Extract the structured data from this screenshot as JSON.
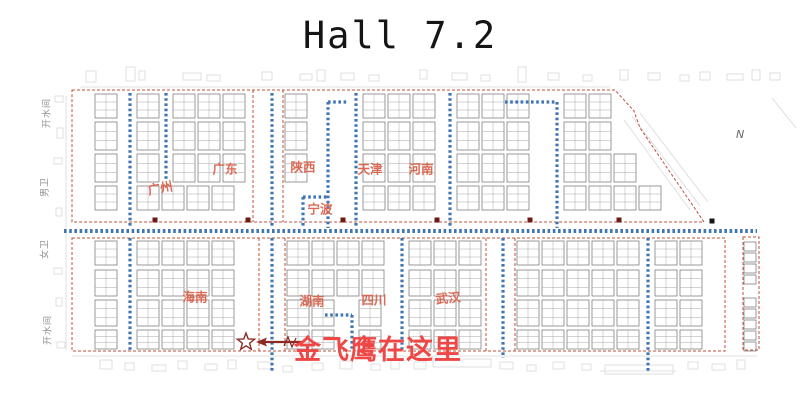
{
  "title": "Hall 7.2",
  "compass": "N",
  "annotation": {
    "text": "金飞鹰在这里",
    "color": "#ee4745",
    "arrow_color": "#8e2a25",
    "marker_icon": "star-icon"
  },
  "region_label_color": "#d85f48",
  "region_labels": [
    {
      "text": "广州"
    },
    {
      "text": "广东"
    },
    {
      "text": "陕西"
    },
    {
      "text": "天津"
    },
    {
      "text": "河南"
    },
    {
      "text": "宁波"
    },
    {
      "text": "海南"
    },
    {
      "text": "湖南"
    },
    {
      "text": "四川"
    },
    {
      "text": "武汉"
    }
  ],
  "facility_labels": [
    {
      "text": "开水间"
    },
    {
      "text": "男卫"
    },
    {
      "text": "女卫"
    },
    {
      "text": "开水间"
    }
  ],
  "floorplan": {
    "colors": {
      "outline": "#c0503a",
      "aisle": "#3f74b5",
      "booth": "#6e6e6e",
      "booth_inner": "#a8a8a8",
      "pillar": "#6b1b13",
      "pillar_black": "#151515",
      "deco": "#d8d8d8",
      "marker": "#8e2a25"
    },
    "booth": {
      "w": 22,
      "gap": 3
    },
    "bands": [
      {
        "y": 94,
        "h": 24,
        "x0": 95,
        "x1": 612,
        "gaps": [
          [
            124,
            136
          ],
          [
            160,
            172
          ],
          [
            252,
            284
          ],
          [
            322,
            334
          ],
          [
            350,
            362
          ],
          [
            444,
            456
          ],
          [
            551,
            563
          ]
        ]
      },
      {
        "y": 122,
        "h": 28,
        "x0": 95,
        "x1": 634,
        "gaps": [
          [
            124,
            136
          ],
          [
            160,
            172
          ],
          [
            252,
            284
          ],
          [
            322,
            334
          ],
          [
            350,
            362
          ],
          [
            444,
            456
          ],
          [
            551,
            563
          ]
        ]
      },
      {
        "y": 154,
        "h": 28,
        "x0": 95,
        "x1": 654,
        "gaps": [
          [
            124,
            136
          ],
          [
            160,
            172
          ],
          [
            252,
            284
          ],
          [
            322,
            334
          ],
          [
            350,
            362
          ],
          [
            444,
            456
          ],
          [
            551,
            563
          ]
        ]
      },
      {
        "y": 186,
        "h": 24,
        "x0": 95,
        "x1": 676,
        "gaps": [
          [
            124,
            136
          ],
          [
            252,
            284
          ],
          [
            297,
            309
          ],
          [
            322,
            334
          ],
          [
            350,
            362
          ],
          [
            444,
            456
          ],
          [
            551,
            563
          ]
        ]
      },
      {
        "y": 241,
        "h": 24,
        "x0": 95,
        "x1": 715,
        "gaps": [
          [
            124,
            136
          ],
          [
            258,
            286
          ],
          [
            396,
            408
          ],
          [
            485,
            516
          ],
          [
            642,
            654
          ]
        ]
      },
      {
        "y": 270,
        "h": 26,
        "x0": 95,
        "x1": 715,
        "gaps": [
          [
            124,
            136
          ],
          [
            258,
            286
          ],
          [
            396,
            408
          ],
          [
            485,
            516
          ],
          [
            642,
            654
          ]
        ]
      },
      {
        "y": 300,
        "h": 26,
        "x0": 95,
        "x1": 715,
        "gaps": [
          [
            124,
            136
          ],
          [
            258,
            286
          ],
          [
            346,
            358
          ],
          [
            396,
            408
          ],
          [
            485,
            516
          ],
          [
            642,
            654
          ]
        ]
      },
      {
        "y": 330,
        "h": 19,
        "x0": 95,
        "x1": 715,
        "gaps": [
          [
            124,
            136
          ],
          [
            258,
            286
          ],
          [
            346,
            358
          ],
          [
            396,
            408
          ],
          [
            485,
            516
          ],
          [
            642,
            654
          ]
        ]
      }
    ],
    "strip": {
      "x": 744,
      "w": 12,
      "h": 9,
      "cells": [
        242,
        253,
        264,
        275,
        298,
        309,
        320,
        331,
        342
      ]
    },
    "outlines": [
      "M72,90 L615,90 L634,111 L640,128 L704,222 L72,222 Z",
      "M72,238 H725 V351 H72 Z",
      "M743,237 H759 V350 H743 Z",
      "M253,90 V222",
      "M283,90 V222",
      "M259,238 V351",
      "M285,238 V351",
      "M486,238 V351",
      "M515,238 V351"
    ],
    "aisles": [
      [
        64,
        231,
        757,
        231,
        4
      ],
      [
        130,
        93,
        130,
        228,
        3.2
      ],
      [
        166,
        93,
        166,
        180,
        3.2
      ],
      [
        272,
        93,
        272,
        228,
        3.2
      ],
      [
        303,
        197,
        303,
        228,
        3.2
      ],
      [
        328,
        102,
        328,
        228,
        3.2
      ],
      [
        356,
        93,
        356,
        228,
        3.2
      ],
      [
        450,
        93,
        450,
        228,
        3.2
      ],
      [
        557,
        102,
        557,
        228,
        3.2
      ],
      [
        303,
        197,
        328,
        197,
        3.2
      ],
      [
        328,
        102,
        348,
        102,
        3.2
      ],
      [
        505,
        102,
        557,
        102,
        3.2
      ],
      [
        130,
        238,
        130,
        351,
        3.2
      ],
      [
        272,
        238,
        272,
        372,
        3.2
      ],
      [
        352,
        315,
        352,
        351,
        3.2
      ],
      [
        402,
        238,
        402,
        351,
        3.2
      ],
      [
        503,
        238,
        503,
        358,
        3.2
      ],
      [
        648,
        238,
        648,
        373,
        3.2
      ],
      [
        325,
        315,
        352,
        315,
        3.2
      ]
    ],
    "pillars": [
      [
        155,
        220
      ],
      [
        248,
        220
      ],
      [
        343,
        220
      ],
      [
        437,
        220
      ],
      [
        530,
        220
      ],
      [
        619,
        220
      ],
      [
        712,
        221,
        "b"
      ]
    ],
    "marker": {
      "cx": 246,
      "cy": 342,
      "r": 9
    },
    "deco": {
      "rects": [
        [
          86,
          71,
          10,
          11
        ],
        [
          126,
          67,
          9,
          14
        ],
        [
          139,
          71,
          6,
          9
        ],
        [
          183,
          73,
          18,
          7
        ],
        [
          207,
          75,
          13,
          6
        ],
        [
          262,
          72,
          10,
          8
        ],
        [
          300,
          74,
          12,
          6
        ],
        [
          317,
          70,
          8,
          11
        ],
        [
          341,
          73,
          13,
          7
        ],
        [
          369,
          75,
          10,
          6
        ],
        [
          420,
          70,
          7,
          9
        ],
        [
          452,
          73,
          15,
          7
        ],
        [
          481,
          75,
          9,
          6
        ],
        [
          518,
          67,
          8,
          15
        ],
        [
          548,
          73,
          11,
          7
        ],
        [
          583,
          75,
          9,
          6
        ],
        [
          620,
          70,
          8,
          10
        ],
        [
          648,
          73,
          12,
          7
        ],
        [
          680,
          75,
          9,
          6
        ],
        [
          700,
          72,
          10,
          8
        ],
        [
          727,
          74,
          16,
          6
        ],
        [
          752,
          70,
          8,
          10
        ],
        [
          770,
          73,
          10,
          7
        ],
        [
          100,
          360,
          12,
          9
        ],
        [
          125,
          363,
          9,
          7
        ],
        [
          152,
          365,
          14,
          6
        ],
        [
          178,
          361,
          9,
          8
        ],
        [
          205,
          364,
          12,
          6
        ],
        [
          228,
          360,
          8,
          9
        ],
        [
          258,
          362,
          13,
          7
        ],
        [
          283,
          366,
          9,
          6
        ],
        [
          312,
          363,
          11,
          7
        ],
        [
          340,
          361,
          12,
          8
        ],
        [
          371,
          364,
          9,
          6
        ],
        [
          391,
          360,
          8,
          9
        ],
        [
          414,
          362,
          12,
          7
        ],
        [
          433,
          359,
          58,
          8
        ],
        [
          500,
          362,
          13,
          7
        ],
        [
          527,
          365,
          9,
          6
        ],
        [
          553,
          362,
          11,
          7
        ],
        [
          582,
          364,
          9,
          6
        ],
        [
          605,
          365,
          68,
          9
        ],
        [
          688,
          362,
          10,
          7
        ],
        [
          712,
          364,
          13,
          6
        ],
        [
          737,
          360,
          8,
          9
        ],
        [
          55,
          96,
          8,
          6
        ],
        [
          57,
          128,
          6,
          10
        ],
        [
          54,
          158,
          8,
          6
        ],
        [
          56,
          208,
          6,
          8
        ],
        [
          54,
          268,
          8,
          6
        ],
        [
          56,
          298,
          6,
          8
        ],
        [
          57,
          342,
          8,
          6
        ]
      ],
      "lines": [
        [
          80,
          87,
          610,
          87
        ],
        [
          72,
          356,
          757,
          356
        ],
        [
          66,
          96,
          66,
          350
        ],
        [
          624,
          120,
          690,
          210
        ],
        [
          632,
          116,
          700,
          206
        ],
        [
          640,
          113,
          708,
          202
        ],
        [
          772,
          98,
          796,
          128
        ],
        [
          600,
          371,
          676,
          371
        ]
      ]
    }
  }
}
